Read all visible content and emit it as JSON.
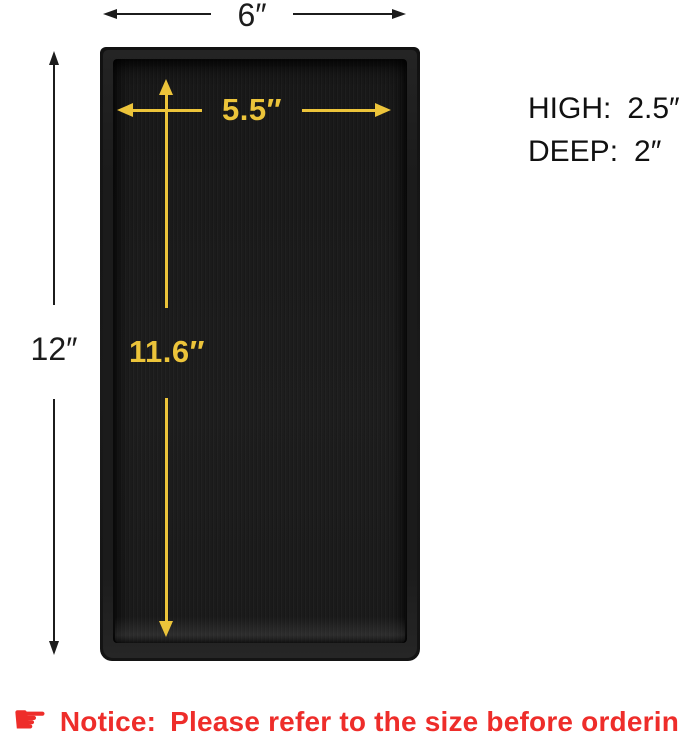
{
  "colors": {
    "accent_yellow": "#ecc43a",
    "notice_red": "#ee2d2a",
    "tray_black": "#1a1a1a",
    "dim_black": "#1c1c1c"
  },
  "tray": {
    "description": "black rectangular tray top view"
  },
  "dimensions": {
    "outer_width": {
      "value": "6″"
    },
    "outer_height": {
      "value": "12″"
    },
    "inner_width": {
      "value": "5.5″"
    },
    "inner_height": {
      "value": "11.6″"
    },
    "high": {
      "label": "HIGH:",
      "value": "2.5″"
    },
    "deep": {
      "label": "DEEP:",
      "value": "2″"
    }
  },
  "notice": {
    "icon": "pointing-hand",
    "icon_glyph": "☛",
    "label": "Notice:",
    "text": "Please refer to the size before ordering"
  }
}
